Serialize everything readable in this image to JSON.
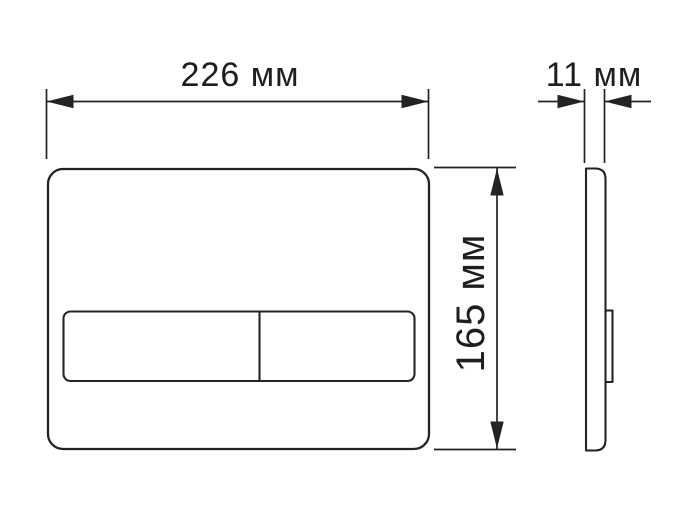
{
  "drawing": {
    "colors": {
      "line": "#232323",
      "background": "#ffffff"
    },
    "unit": "мм",
    "dimensions": {
      "width": {
        "label": "226 мм",
        "value": 226,
        "unit": "мм"
      },
      "depth": {
        "label": "11 мм",
        "value": 11,
        "unit": "мм"
      },
      "height": {
        "label": "165 мм",
        "value": 165,
        "unit": "мм"
      }
    }
  }
}
